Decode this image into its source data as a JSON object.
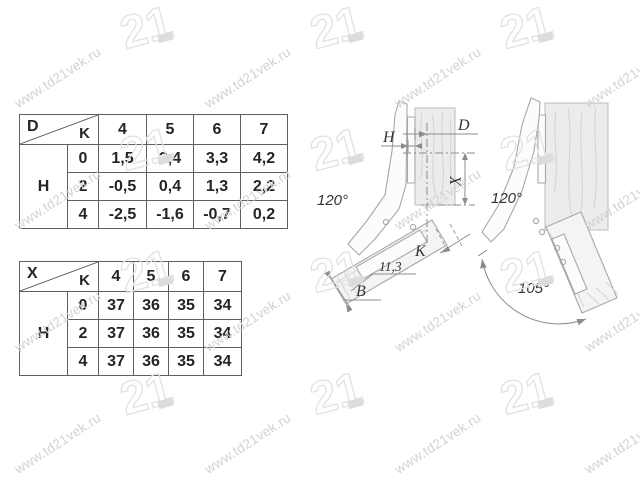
{
  "watermark": {
    "text": "www.td21vek.ru",
    "logo_text": "21"
  },
  "colors": {
    "watermark": "#d2d2d2",
    "table_border": "#5f5f5f",
    "drawing_line": "#a8a8a8",
    "dimension_line": "#8c8c8c",
    "text": "#242424"
  },
  "table_d": {
    "corner_top": "D",
    "corner_bottom": "K",
    "row_group": "H",
    "col_headers": [
      "4",
      "5",
      "6",
      "7"
    ],
    "rows": [
      {
        "h": "0",
        "values": [
          "1,5",
          "2,4",
          "3,3",
          "4,2"
        ]
      },
      {
        "h": "2",
        "values": [
          "-0,5",
          "0,4",
          "1,3",
          "2,2"
        ]
      },
      {
        "h": "4",
        "values": [
          "-2,5",
          "-1,6",
          "-0,7",
          "0,2"
        ]
      }
    ]
  },
  "table_x": {
    "corner_top": "X",
    "corner_bottom": "K",
    "row_group": "H",
    "col_headers": [
      "4",
      "5",
      "6",
      "7"
    ],
    "rows": [
      {
        "h": "0",
        "values": [
          "37",
          "36",
          "35",
          "34"
        ]
      },
      {
        "h": "2",
        "values": [
          "37",
          "36",
          "35",
          "34"
        ]
      },
      {
        "h": "4",
        "values": [
          "37",
          "36",
          "35",
          "34"
        ]
      }
    ]
  },
  "diagram_left": {
    "angle": "120°",
    "dims": {
      "d": "D",
      "h": "H",
      "x": "X",
      "k": "K",
      "b": "B",
      "depth": "11,3"
    }
  },
  "diagram_right": {
    "angle": "120°",
    "arc": "105°"
  }
}
